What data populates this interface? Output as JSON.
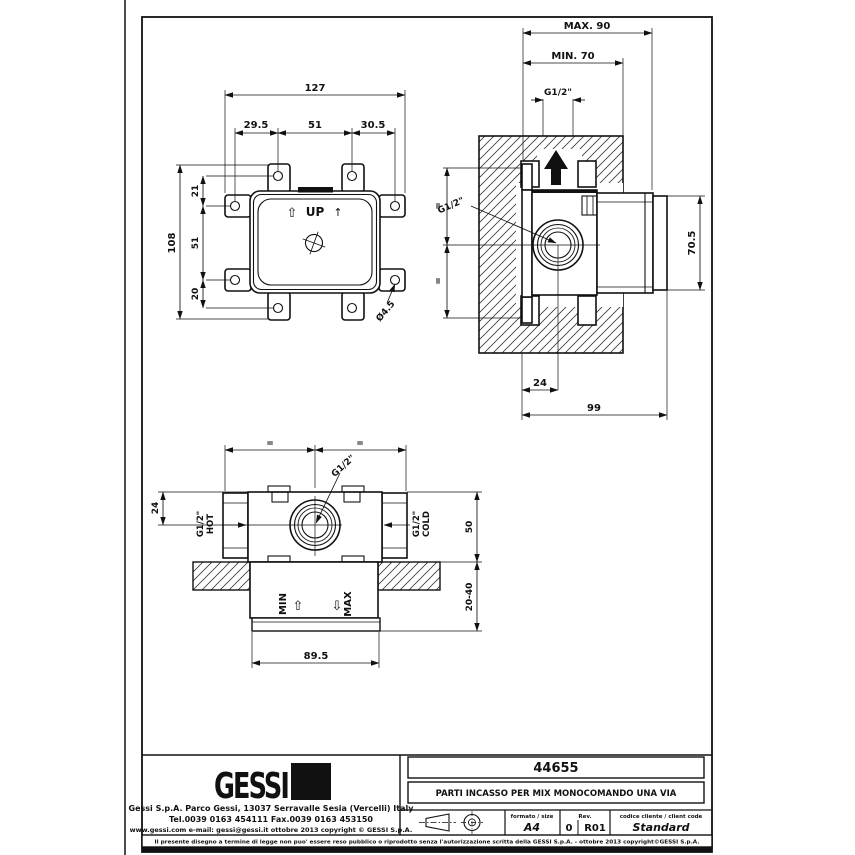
{
  "page": {
    "background": "#ffffff",
    "line_color": "#111111"
  },
  "views": {
    "front": {
      "up_label": "UP",
      "dims": {
        "overall_width": "127",
        "spacing_left": "29.5",
        "spacing_center": "51",
        "spacing_right": "30.5",
        "overall_height": "108",
        "v_top": "21",
        "v_mid": "51",
        "v_bottom": "20",
        "hole_diameter": "Ø4.5"
      }
    },
    "side": {
      "dims": {
        "max_depth": "MAX. 90",
        "min_depth": "MIN. 70",
        "thread_top": "G1/2\"",
        "thread_inlet": "G1/2\"",
        "body_height": "70.5",
        "center_offset": "24",
        "total_depth": "99",
        "equal_top": "=",
        "equal_bottom": "="
      }
    },
    "top": {
      "labels": {
        "min": "MIN",
        "max": "MAX",
        "hot": "HOT",
        "cold": "COLD"
      },
      "dims": {
        "equal_left": "=",
        "equal_right": "=",
        "thread_center": "G1/2\"",
        "thread_hot": "G1/2\"",
        "thread_cold": "G1/2\"",
        "center_offset": "24",
        "body_depth": "50",
        "wall_range": "20-40",
        "body_width": "89.5"
      }
    }
  },
  "icons": {
    "up_arrow_outline": "⇧",
    "up_arrow_thin": "↑",
    "down_arrow_outline": "⇩"
  },
  "title_block": {
    "logo_text": "GESSI",
    "company_line1": "Gessi S.p.A. Parco Gessi, 13037 Serravalle Sesia (Vercelli) Italy",
    "company_line2": "Tel.0039 0163 454111 Fax.0039 0163 453150",
    "company_line3": "www.gessi.com e-mail: gessi@gessi.it  ottobre 2013  copyright © GESSI S.p.A.",
    "part_number": "44655",
    "description": "PARTI INCASSO PER MIX MONOCOMANDO UNA VIA",
    "format_label": "formato / size",
    "format_value": "A4",
    "rev_label": "Rev.",
    "rev_value_1": "0",
    "rev_value_2": "R01",
    "client_code_label": "codice cliente / client code",
    "client_code_value": "Standard",
    "disclaimer": "Il presente disegno a termine di legge non puo' essere reso pubblico o riprodotto senza l'autorizzazione scritta della GESSI S.p.A. - ottobre 2013 copyright©GESSI S.p.A."
  }
}
